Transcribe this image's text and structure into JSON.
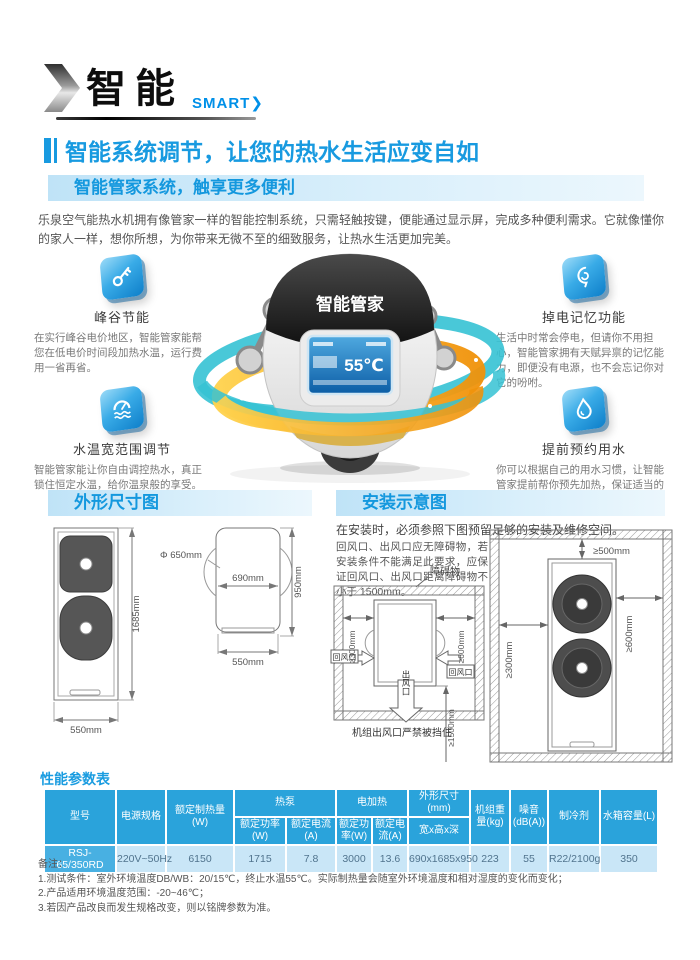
{
  "logo": {
    "title": "智能",
    "subtitle": "SMART"
  },
  "headline": "智能系统调节，让您的热水生活应变自如",
  "intro": {
    "bar": "智能管家系统，触享更多便利",
    "paragraph": "乐泉空气能热水机拥有像管家一样的智能控制系统，只需轻触按键，便能通过显示屏，完成多种便利需求。它就像懂你的家人一样，想你所想，为你带来无微不至的细致服务，让热水生活更加完美。"
  },
  "features": [
    {
      "icon": "key-icon",
      "title": "峰谷节能",
      "desc": "在实行峰谷电价地区，智能管家能帮您在低电价时间段加热水温，运行费用一省再省。"
    },
    {
      "icon": "memory-icon",
      "title": "掉电记忆功能",
      "desc": "生活中时常会停电，但请你不用担心，智能管家拥有天赋异禀的记忆能力，即便没有电源，也不会忘记你对它的吩咐。"
    },
    {
      "icon": "thermostat-icon",
      "title": "水温宽范围调节",
      "desc": "智能管家能让你自由调控热水，真正锁住恒定水温，给你温泉般的享受。"
    },
    {
      "icon": "waterdrop-icon",
      "title": "提前预约用水",
      "desc": "你可以根据自己的用水习惯，让智能管家提前帮你预先加热，保证适当的热水量。"
    }
  ],
  "robot": {
    "label": "智能管家",
    "screen_temp": "55℃"
  },
  "dims": {
    "bar": "外形尺寸图",
    "front_height": "1685mm",
    "front_width": "550mm",
    "fan_dia": "Φ 650mm",
    "side_depth": "690mm",
    "side_height": "950mm",
    "side_width": "550mm"
  },
  "install": {
    "bar": "安装示意图",
    "note": "在安装时，必须参照下图预留足够的安装及维修空间。",
    "tip": "回风口、出风口应无障碍物，若安装条件不能满足此要求，应保证回风口、出风口距离障碍物不小于 1500mm。",
    "obstacle": "障碍物",
    "d300": "≥300mm",
    "d600": "≥600mm",
    "d500": "≥500mm",
    "d1500": "≥1500mm",
    "return_air": "回风口",
    "outlet": "出风口",
    "caption": "机组出风口严禁被挡住"
  },
  "table": {
    "title": "性能参数表",
    "headers": {
      "model": "型号",
      "power": "电源规格",
      "heating": "额定制热量(W)",
      "hp": "热泵",
      "eh": "电加热",
      "hp_power": "额定功率(W)",
      "hp_current": "额定电流(A)",
      "eh_power": "额定功率(W)",
      "eh_current": "额定电流(A)",
      "dim": "外形尺寸(mm)",
      "dim_sub": "宽x高x深",
      "weight": "机组重量(kg)",
      "noise": "噪音(dB(A))",
      "refrigerant": "制冷剂",
      "tank": "水箱容量(L)"
    },
    "row": [
      "RSJ-65/350RD",
      "220V~50Hz",
      "6150",
      "1715",
      "7.8",
      "3000",
      "13.6",
      "690x1685x950",
      "223",
      "55",
      "R22/2100g",
      "350"
    ]
  },
  "notes": {
    "title": "备注：",
    "items": [
      "1.测试条件：室外环境温度DB/WB：20/15℃，终止水温55℃。实际制热量会随室外环境温度和相对湿度的变化而变化；",
      "2.产品适用环境温度范围：-20~46℃；",
      "3.若因产品改良而发生规格改变，则以铭牌参数为准。"
    ]
  },
  "colors": {
    "accent": "#189ae0",
    "table_header": "#2aa3db",
    "table_row": "#c9e6f7",
    "highlight_cell": "#48b0e2",
    "ring_teal": "#35c2d4",
    "ring_orange": "#f5a623",
    "tile_blue": "#1b8fd6"
  }
}
